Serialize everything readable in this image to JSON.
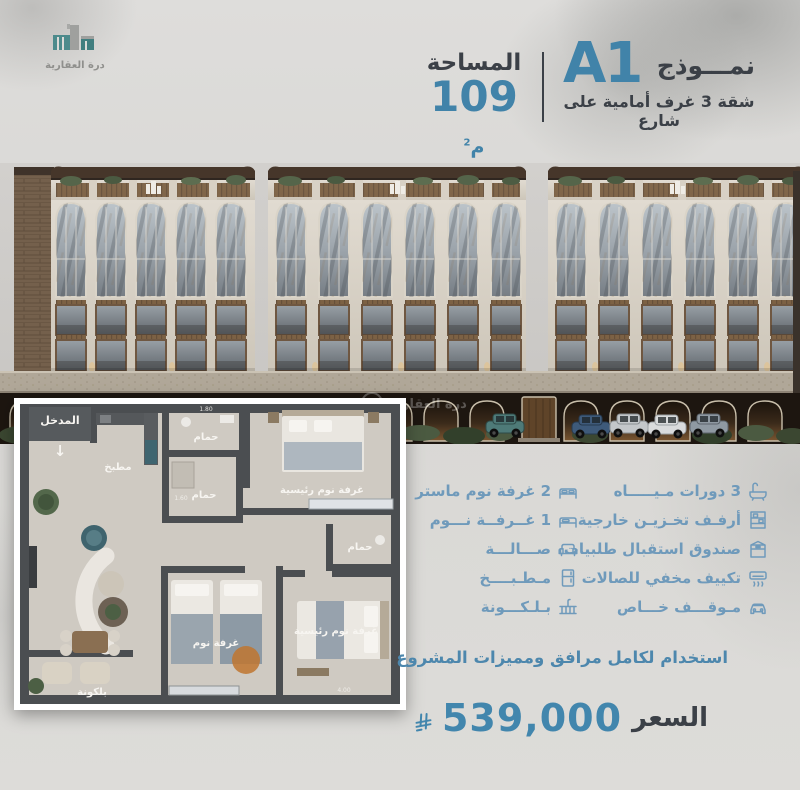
{
  "brand": {
    "name": "درة العقارية"
  },
  "header": {
    "model_label": "نمـــوذج",
    "model_code": "A1",
    "subtitle": "شقة 3 غرف أمامية على شارع",
    "area_label": "المساحة",
    "area_value": "109",
    "area_unit": "م",
    "area_sup": "2"
  },
  "floor_plan": {
    "entrance": "المدخل",
    "entrance_arrow": "↓",
    "kitchen": "مطبخ",
    "bathroom": "حمام",
    "master_bedroom": "غرفة نوم رئيسية",
    "bedroom": "غرفة نوم",
    "balcony": "بلكونة",
    "dims": {
      "a": "1.80",
      "b": "1.60",
      "c": "4.00"
    }
  },
  "features": {
    "right_column": [
      {
        "icon": "bathroom-icon",
        "label": "3 دورات مـيـــــاه"
      },
      {
        "icon": "storage-shelves-icon",
        "label": "أرفـف تخـزيـن خارجية"
      },
      {
        "icon": "parcel-box-icon",
        "label": "صندوق استقبال طلبيات"
      },
      {
        "icon": "air-conditioner-icon",
        "label": "تكييف مخفي للصالات"
      },
      {
        "icon": "parking-icon",
        "label": "مـوقـــف خـــاص"
      }
    ],
    "left_column": [
      {
        "icon": "double-bed-icon",
        "label": "2 غرفة نوم ماستر"
      },
      {
        "icon": "single-bed-icon",
        "label": "1 غــرفــة نـــوم"
      },
      {
        "icon": "sofa-icon",
        "label": "صـــالـــة"
      },
      {
        "icon": "kitchen-icon",
        "label": "مـطـبــــخ"
      },
      {
        "icon": "balcony-icon",
        "label": "بـلـكـــونة"
      }
    ]
  },
  "footer": {
    "usage_note": "استخدام لكامل مرافق ومميزات المشروع",
    "price_label": "السعر",
    "price_value": "539,000",
    "currency": "ريال سعودي"
  },
  "colors": {
    "accent_blue": "#4183a9",
    "feature_blue": "#6f9abb",
    "dark_text": "#3b4047",
    "logo_teal": "#4d8b8c",
    "background": "#dcdbd8"
  }
}
